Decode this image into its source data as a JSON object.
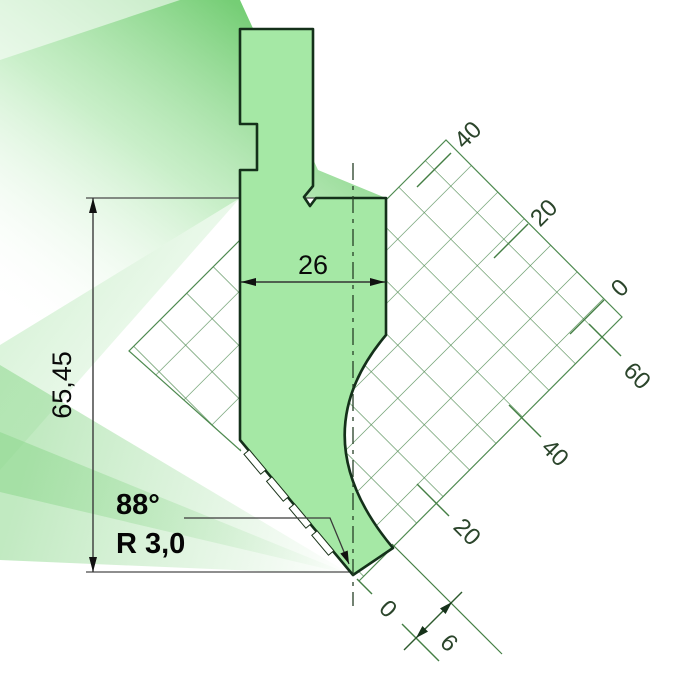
{
  "diagram": {
    "kind": "press-brake-punch-technical-drawing",
    "dimensions": {
      "height": "65,45",
      "width": "26",
      "angle": "88°",
      "radius": "R 3,0",
      "tip_offset": "6"
    },
    "axis_a": {
      "labels": [
        "40",
        "20",
        "0"
      ]
    },
    "axis_b": {
      "labels": [
        "60",
        "40",
        "20",
        "0"
      ]
    },
    "colors": {
      "punch_fill": "#a5e8a5",
      "punch_outline": "#14301a",
      "grid_line": "#4e8a50",
      "axis_text": "#2b452b",
      "dimension_line": "#3a3a3a",
      "dimension_text": "#0a0a0a",
      "beam_green": "#6ecb6e",
      "background": "#ffffff"
    }
  }
}
